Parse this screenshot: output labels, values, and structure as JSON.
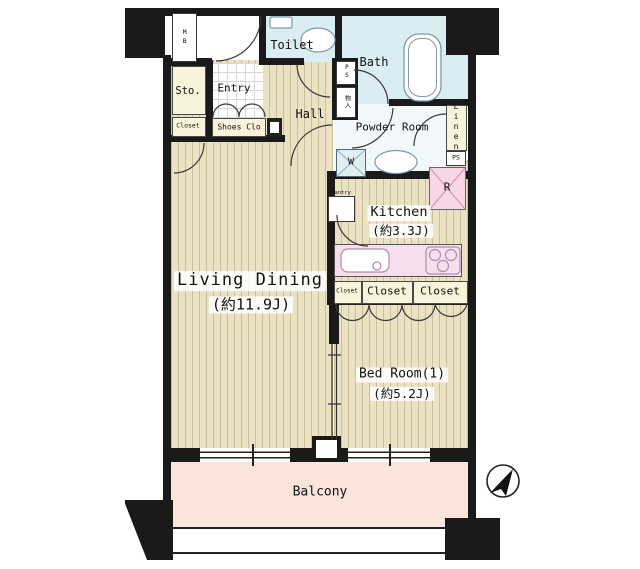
{
  "rooms": {
    "living_dining": {
      "label": "Living Dining",
      "size": "(約11.9J)"
    },
    "bed_room": {
      "label": "Bed Room(1)",
      "size": "(約5.2J)"
    },
    "kitchen": {
      "label": "Kitchen",
      "size": "(約3.3J)"
    },
    "balcony": {
      "label": "Balcony"
    },
    "bath": {
      "label": "Bath"
    },
    "toilet": {
      "label": "Toilet"
    },
    "powder_room": {
      "label": "Powder Room"
    },
    "hall": {
      "label": "Hall"
    },
    "entry": {
      "label": "Entry"
    },
    "storage": {
      "label": "Sto."
    },
    "shoes_closet": {
      "label": "Shoes Clo"
    },
    "closet_hall": {
      "label": "Closet"
    },
    "closet_small": {
      "label": "Closet"
    },
    "closet_1": {
      "label": "Closet"
    },
    "closet_2": {
      "label": "Closet"
    },
    "linen": {
      "label": "Linen"
    },
    "pantry": {
      "label": "Pantry"
    }
  },
  "fixtures": {
    "meter_box": "MB",
    "pipe_space_top": "PS",
    "pipe_space_right": "PS",
    "shaft": "物入",
    "washer": "W",
    "refrigerator": "R"
  },
  "colors": {
    "wall": "#1a1a1a",
    "wood_floor": "#eae2c3",
    "wet_area": "#daedf2",
    "closet_cream": "#f8f3da",
    "counter_pink": "#f5dfef",
    "fridge_pink": "#f8d7e5",
    "balcony_peach": "#fbe5da"
  }
}
